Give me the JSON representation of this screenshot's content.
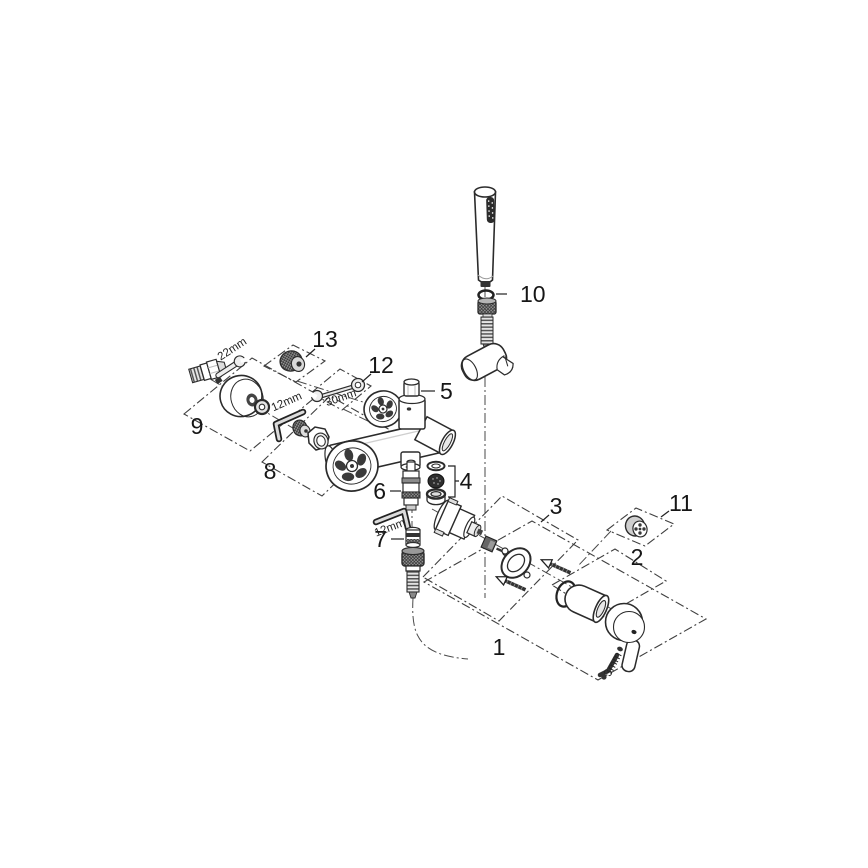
{
  "diagram": {
    "callouts": {
      "c1": "1",
      "c2": "2",
      "c3": "3",
      "c4": "4",
      "c5": "5",
      "c6": "6",
      "c7": "7",
      "c8": "8",
      "c9": "9",
      "c10": "10",
      "c11": "11",
      "c12": "12",
      "c13": "13"
    },
    "tool_labels": {
      "union_wrench": "22mm",
      "inlet_key": "12mm",
      "spout_wrench": "30mm",
      "diverter_key": "12mm",
      "lever_key": "3mm"
    },
    "colors": {
      "background": "#ffffff",
      "line": "#2b2b2b",
      "label_text": "#161616",
      "dark_fill": "#2e2e2e"
    }
  }
}
